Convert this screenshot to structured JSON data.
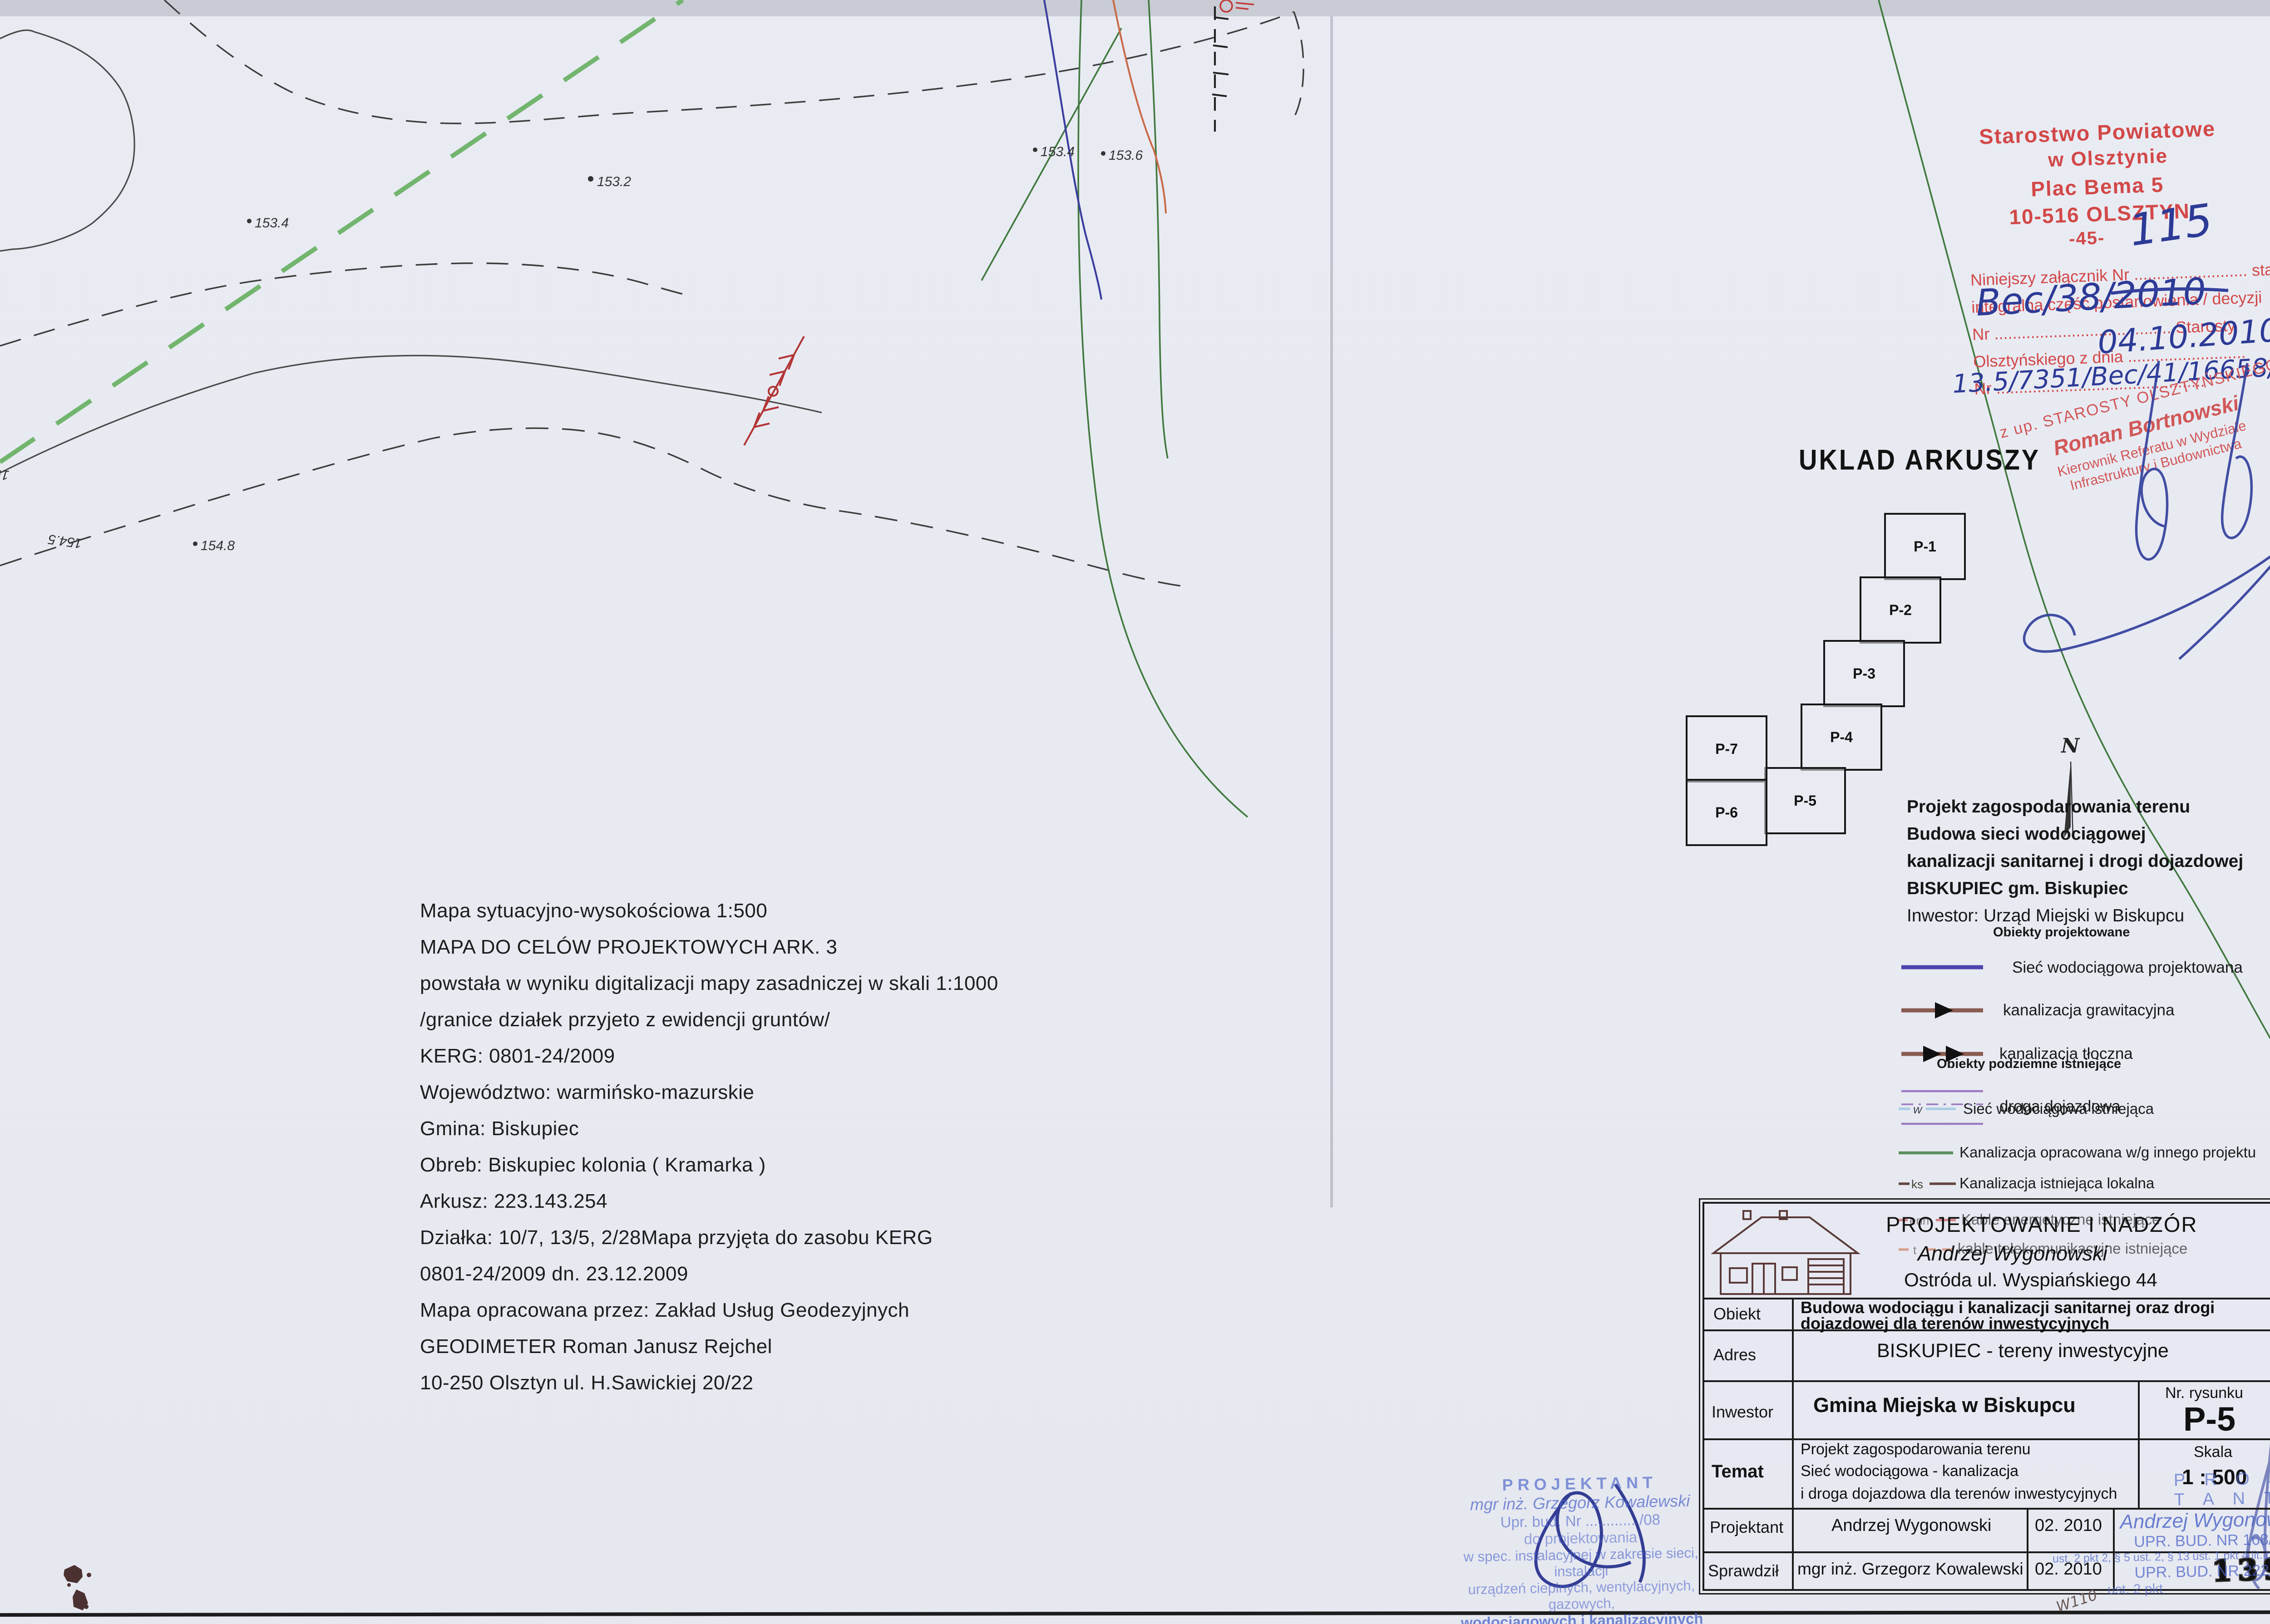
{
  "map": {
    "labels": {
      "h1": "153.4",
      "h2": "153.2",
      "h3": "153.4",
      "h4": "153.6",
      "h5": "154.8",
      "h6": "154.5",
      "h7": "154"
    }
  },
  "office_stamp": {
    "line1": "Starostwo Powiatowe",
    "line2": "w Olsztynie",
    "line3": "Plac Bema 5",
    "line4": "10-516 OLSZTYN",
    "line5": "-45-",
    "form1": "Niniejszy załącznik Nr ......................... stanowi",
    "form2": "integralna część postanowienia / decyzji",
    "form3": "Nr ....................................... Starosty",
    "form4": "Olsztyńskiego z dnia ..........................",
    "form5": "Nr ..............................................",
    "hand_attachment_no": "115",
    "hand_decision_no": "Bec/38/2010",
    "hand_date": "04.10.2010",
    "hand_case_no": "13.5/7351/Bec/41/16658/2010"
  },
  "authority_stamp": {
    "line1": "z up. STAROSTY OLSZTYŃSKIEGO",
    "line2": "Roman Bortnowski",
    "line3": "Kierownik Referatu w Wydziale",
    "line4": "Infrastruktury i Budownictwa"
  },
  "sheet_layout": {
    "title": "UKLAD  ARKUSZY",
    "north": "N",
    "sheets": {
      "p1": "P-1",
      "p2": "P-2",
      "p3": "P-3",
      "p4": "P-4",
      "p5": "P-5",
      "p6": "P-6",
      "p7": "P-7"
    }
  },
  "project_block": {
    "l1": "Projekt zagospodarowania  terenu",
    "l2": "Budowa  sieci wodociągowej",
    "l3": "kanalizacji  sanitarnej i drogi  dojazdowej",
    "l4": "BISKUPIEC gm. Biskupiec",
    "l5": "Inwestor: Urząd Miejski w Biskupcu"
  },
  "legend": {
    "projected_header": "Obiekty projektowane",
    "p1": "Sieć  wodociągowa projektowana",
    "p2": "kanalizacja grawitacyjna",
    "p3": "kanalizacja  tłoczna",
    "p4": "droga  dojazdowa",
    "existing_header": "Obiekty podziemne  istniejące",
    "e1_tag": "w",
    "e1": "Sieć  wodociągowa istniejąca",
    "e2": "Kanalizacja  opracowana w/g innego projektu",
    "e3_tag": "ks",
    "e3": "Kanalizacja  istniejąca  lokalna",
    "e4_tag": "enn",
    "e4": "Kable  energetyczne  istniejące",
    "e5_tag": "t",
    "e5": "kable telekomunikacyjne  istniejące"
  },
  "map_info": {
    "lines": [
      "Mapa sytuacyjno-wysokościowa 1:500",
      "MAPA DO CELÓW PROJEKTOWYCH ARK. 3",
      "powstała w wyniku digitalizacji mapy zasadniczej w skali 1:1000",
      "/granice działek przyjeto z ewidencji gruntów/",
      "KERG: 0801-24/2009",
      "Województwo: warmińsko-mazurskie",
      "Gmina: Biskupiec",
      "Obreb: Biskupiec kolonia ( Kramarka )",
      "Arkusz: 223.143.254",
      "Działka: 10/7, 13/5, 2/28Mapa przyjęta do zasobu KERG",
      "0801-24/2009 dn. 23.12.2009",
      "Mapa opracowana przez: Zakład Usług Geodezyjnych",
      "GEODIMETER Roman Janusz Rejchel",
      "10-250 Olsztyn ul. H.Sawickiej 20/22"
    ]
  },
  "title_block": {
    "company_line1": "PROJEKTOWANIE  I  NADZÓR",
    "company_line2": "Andrzej  Wygonowski",
    "company_line3": "Ostróda ul. Wyspiańskiego 44",
    "obiekt_label": "Obiekt",
    "obiekt_line1": "Budowa wodociągu i kanalizacji sanitarnej  oraz drogi",
    "obiekt_line2": "dojazdowej dla terenów inwestycyjnych",
    "adres_label": "Adres",
    "adres_value": "BISKUPIEC - tereny  inwestycyjne",
    "inwestor_label": "Inwestor",
    "inwestor_value": "Gmina  Miejska w Biskupcu",
    "nr_rysunku_label": "Nr. rysunku",
    "nr_rysunku_value": "P-5",
    "temat_label": "Temat",
    "temat_line1": "Projekt zagospodarowania  terenu",
    "temat_line2": "Sieć wodociągowa - kanalizacja",
    "temat_line3": "i droga dojazdowa  dla terenów inwestycyjnych",
    "skala_label": "Skala",
    "skala_value": "1 : 500",
    "projektant_label": "Projektant",
    "projektant_name": "Andrzej  Wygonowski",
    "projektant_date": "02. 2010",
    "sprawdzil_label": "Sprawdził",
    "sprawdzil_name": "mgr inż. Grzegorz Kowalewski",
    "sprawdzil_date": "02. 2010"
  },
  "designer_stamp": {
    "line1": "PROJEKTANT",
    "line2": "mgr inż. Grzegorz Kowalewski",
    "line3": "Upr. bud. Nr ............ /08",
    "line4": "do projektowania",
    "line5": "w spec. instalacyjnej w zakresie sieci, instalacji",
    "line6": "urządzeń cieplnych, wentylacyjnych, gazowych,",
    "line7": "wodociągowych i kanalizacyjnych"
  },
  "approval_stamp": {
    "line1": "P R O J E K T A N T",
    "line2": "Andrzej Wygonowski",
    "line3": "UPR. BUD. NR 168/82/OL",
    "line4": "ust. 2 pkt 2, § 5 ust. 2, § 13 ust. 1 pkt 4 lit. b, § 6 ust.",
    "line5": "UPR. BUD. NR 222/89/OL",
    "line6": "ust. 2 pkt"
  },
  "page_number": "139",
  "hand_note": "W110"
}
